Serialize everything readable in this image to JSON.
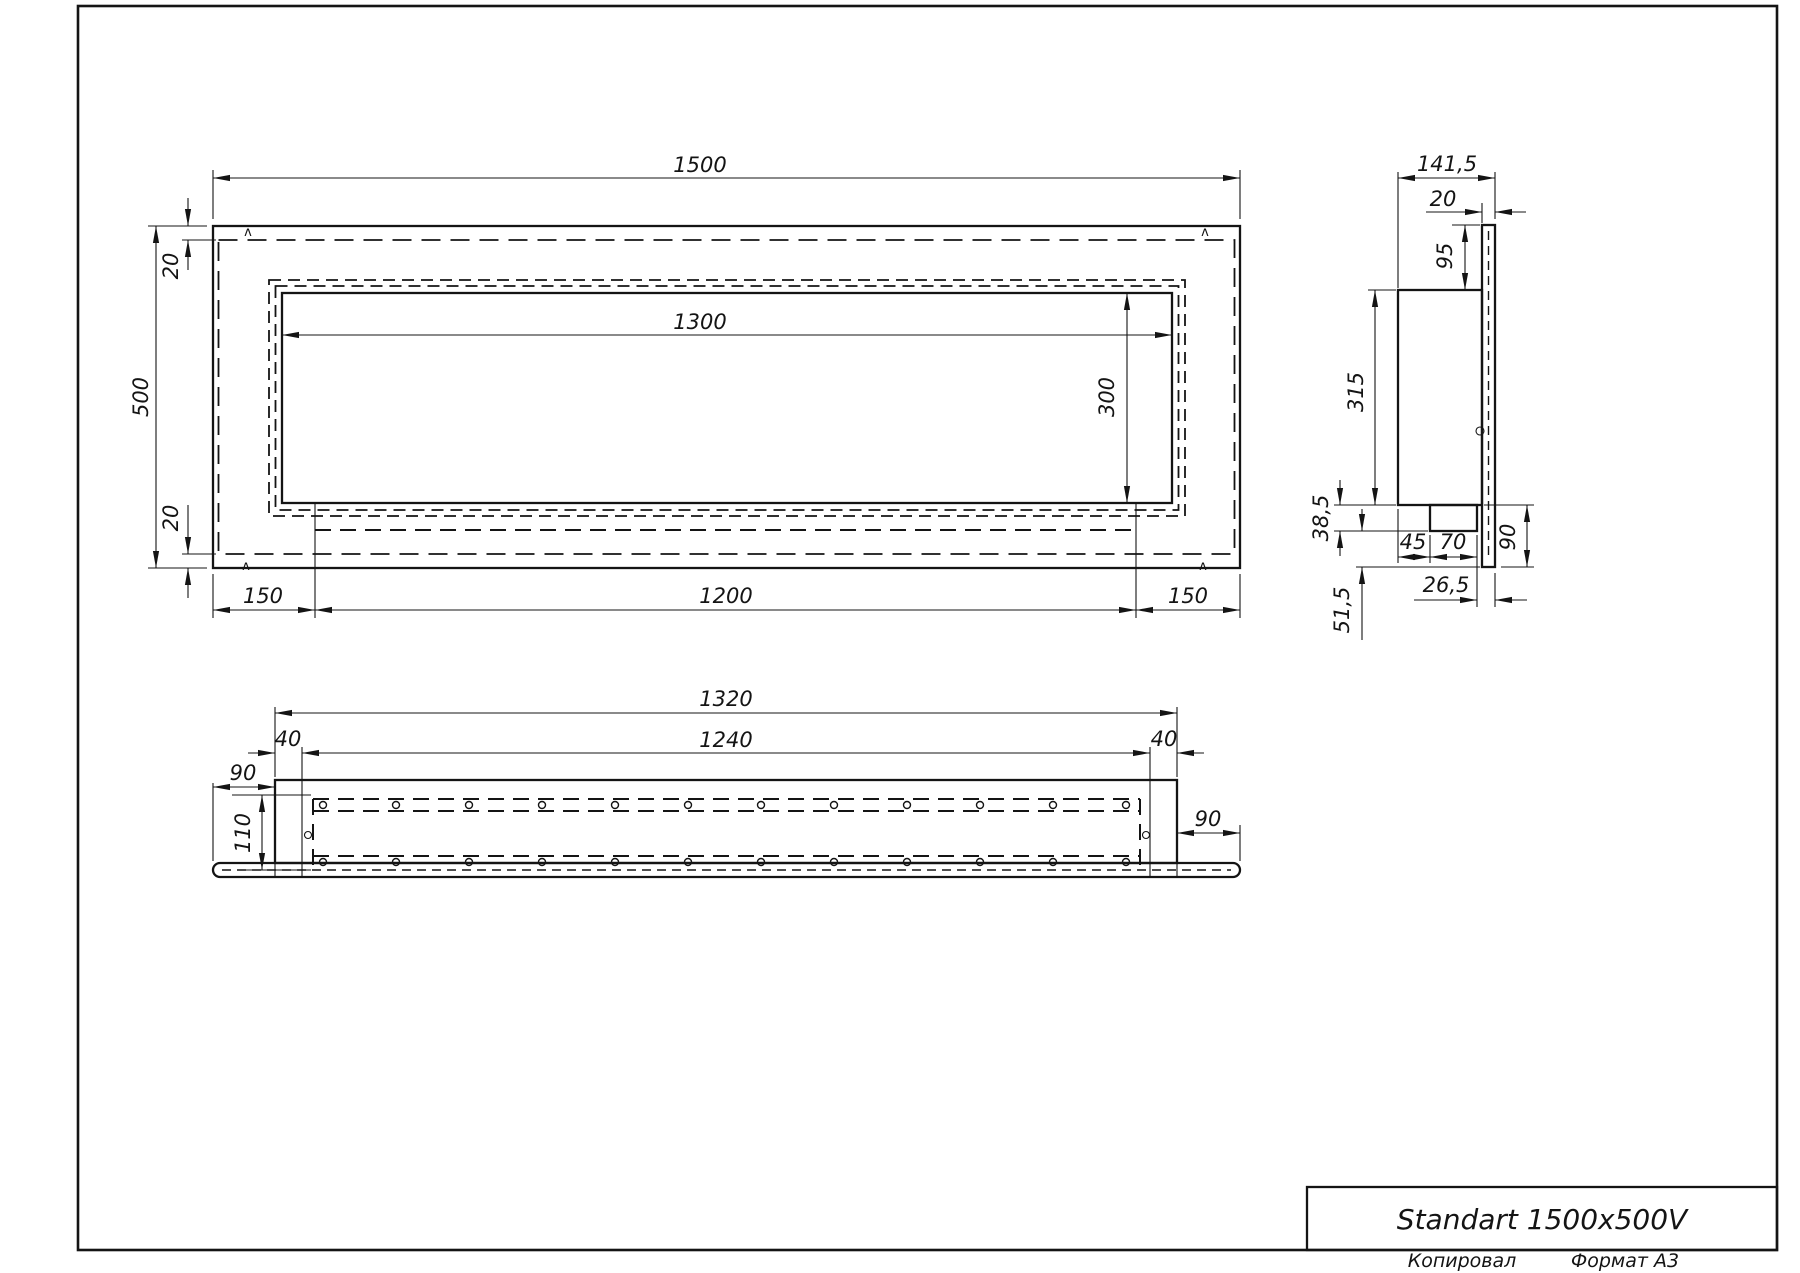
{
  "title_block": {
    "product_name": "Standart 1500x500V"
  },
  "footer": {
    "copied_by_label": "Копировал",
    "format_label": "Формат А3"
  },
  "marks": {
    "bend_mark": "ʌ"
  },
  "front_view": {
    "dims": {
      "overall_width": "1500",
      "overall_height": "500",
      "opening_width": "1300",
      "opening_height": "300",
      "top_inset": "20",
      "bottom_inset": "20",
      "tray_left_offset": "150",
      "tray_length": "1200",
      "tray_right_offset": "150"
    }
  },
  "side_view": {
    "dims": {
      "overall_depth": "141,5",
      "front_plate_thickness": "20",
      "top_offset": "95",
      "body_height": "315",
      "tray_depth": "38,5",
      "tray_setback": "45",
      "tray_width": "70",
      "lower_flange_height": "90",
      "plate_projection": "26,5",
      "lower_offset": "51,5"
    }
  },
  "bottom_view": {
    "dims": {
      "box_length": "1320",
      "channel_length": "1240",
      "left_end_margin": "40",
      "right_end_margin": "40",
      "left_flange": "90",
      "right_flange": "90",
      "channel_depth": "110"
    }
  }
}
